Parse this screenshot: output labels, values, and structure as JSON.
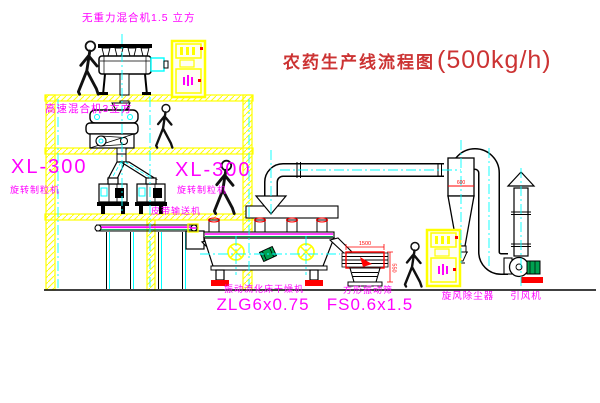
{
  "title": {
    "text": "农药生产线流程图",
    "capacity": "(500kg/h)"
  },
  "labels": {
    "gravity_mixer": "无重力混合机1.5 立方",
    "high_speed_mixer": "高速混合机3立方",
    "granulator_model_left": "XL-300",
    "granulator_name_left": "旋转制粒机",
    "granulator_model_center": "XL-300",
    "granulator_name_center": "旋转制粒机",
    "belt_conveyor": "皮带输送机",
    "dryer_name": "振动流化床干燥机",
    "dryer_model": "ZLG6x0.75",
    "sieve_name": "方形振动筛",
    "sieve_model": "FS0.6x1.5",
    "cyclone": "旋风除尘器",
    "fan": "引风机"
  },
  "dimensions": {
    "sieve_length": "1500",
    "sieve_height": "550",
    "cyclone_width": "600"
  },
  "colors": {
    "structure_yellow": "#ffff00",
    "label_magenta": "#ff00ff",
    "title_red": "#cc3333",
    "centerline_cyan": "#00ffff",
    "dimension_red": "#ff0000",
    "motor_green": "#00a050"
  }
}
